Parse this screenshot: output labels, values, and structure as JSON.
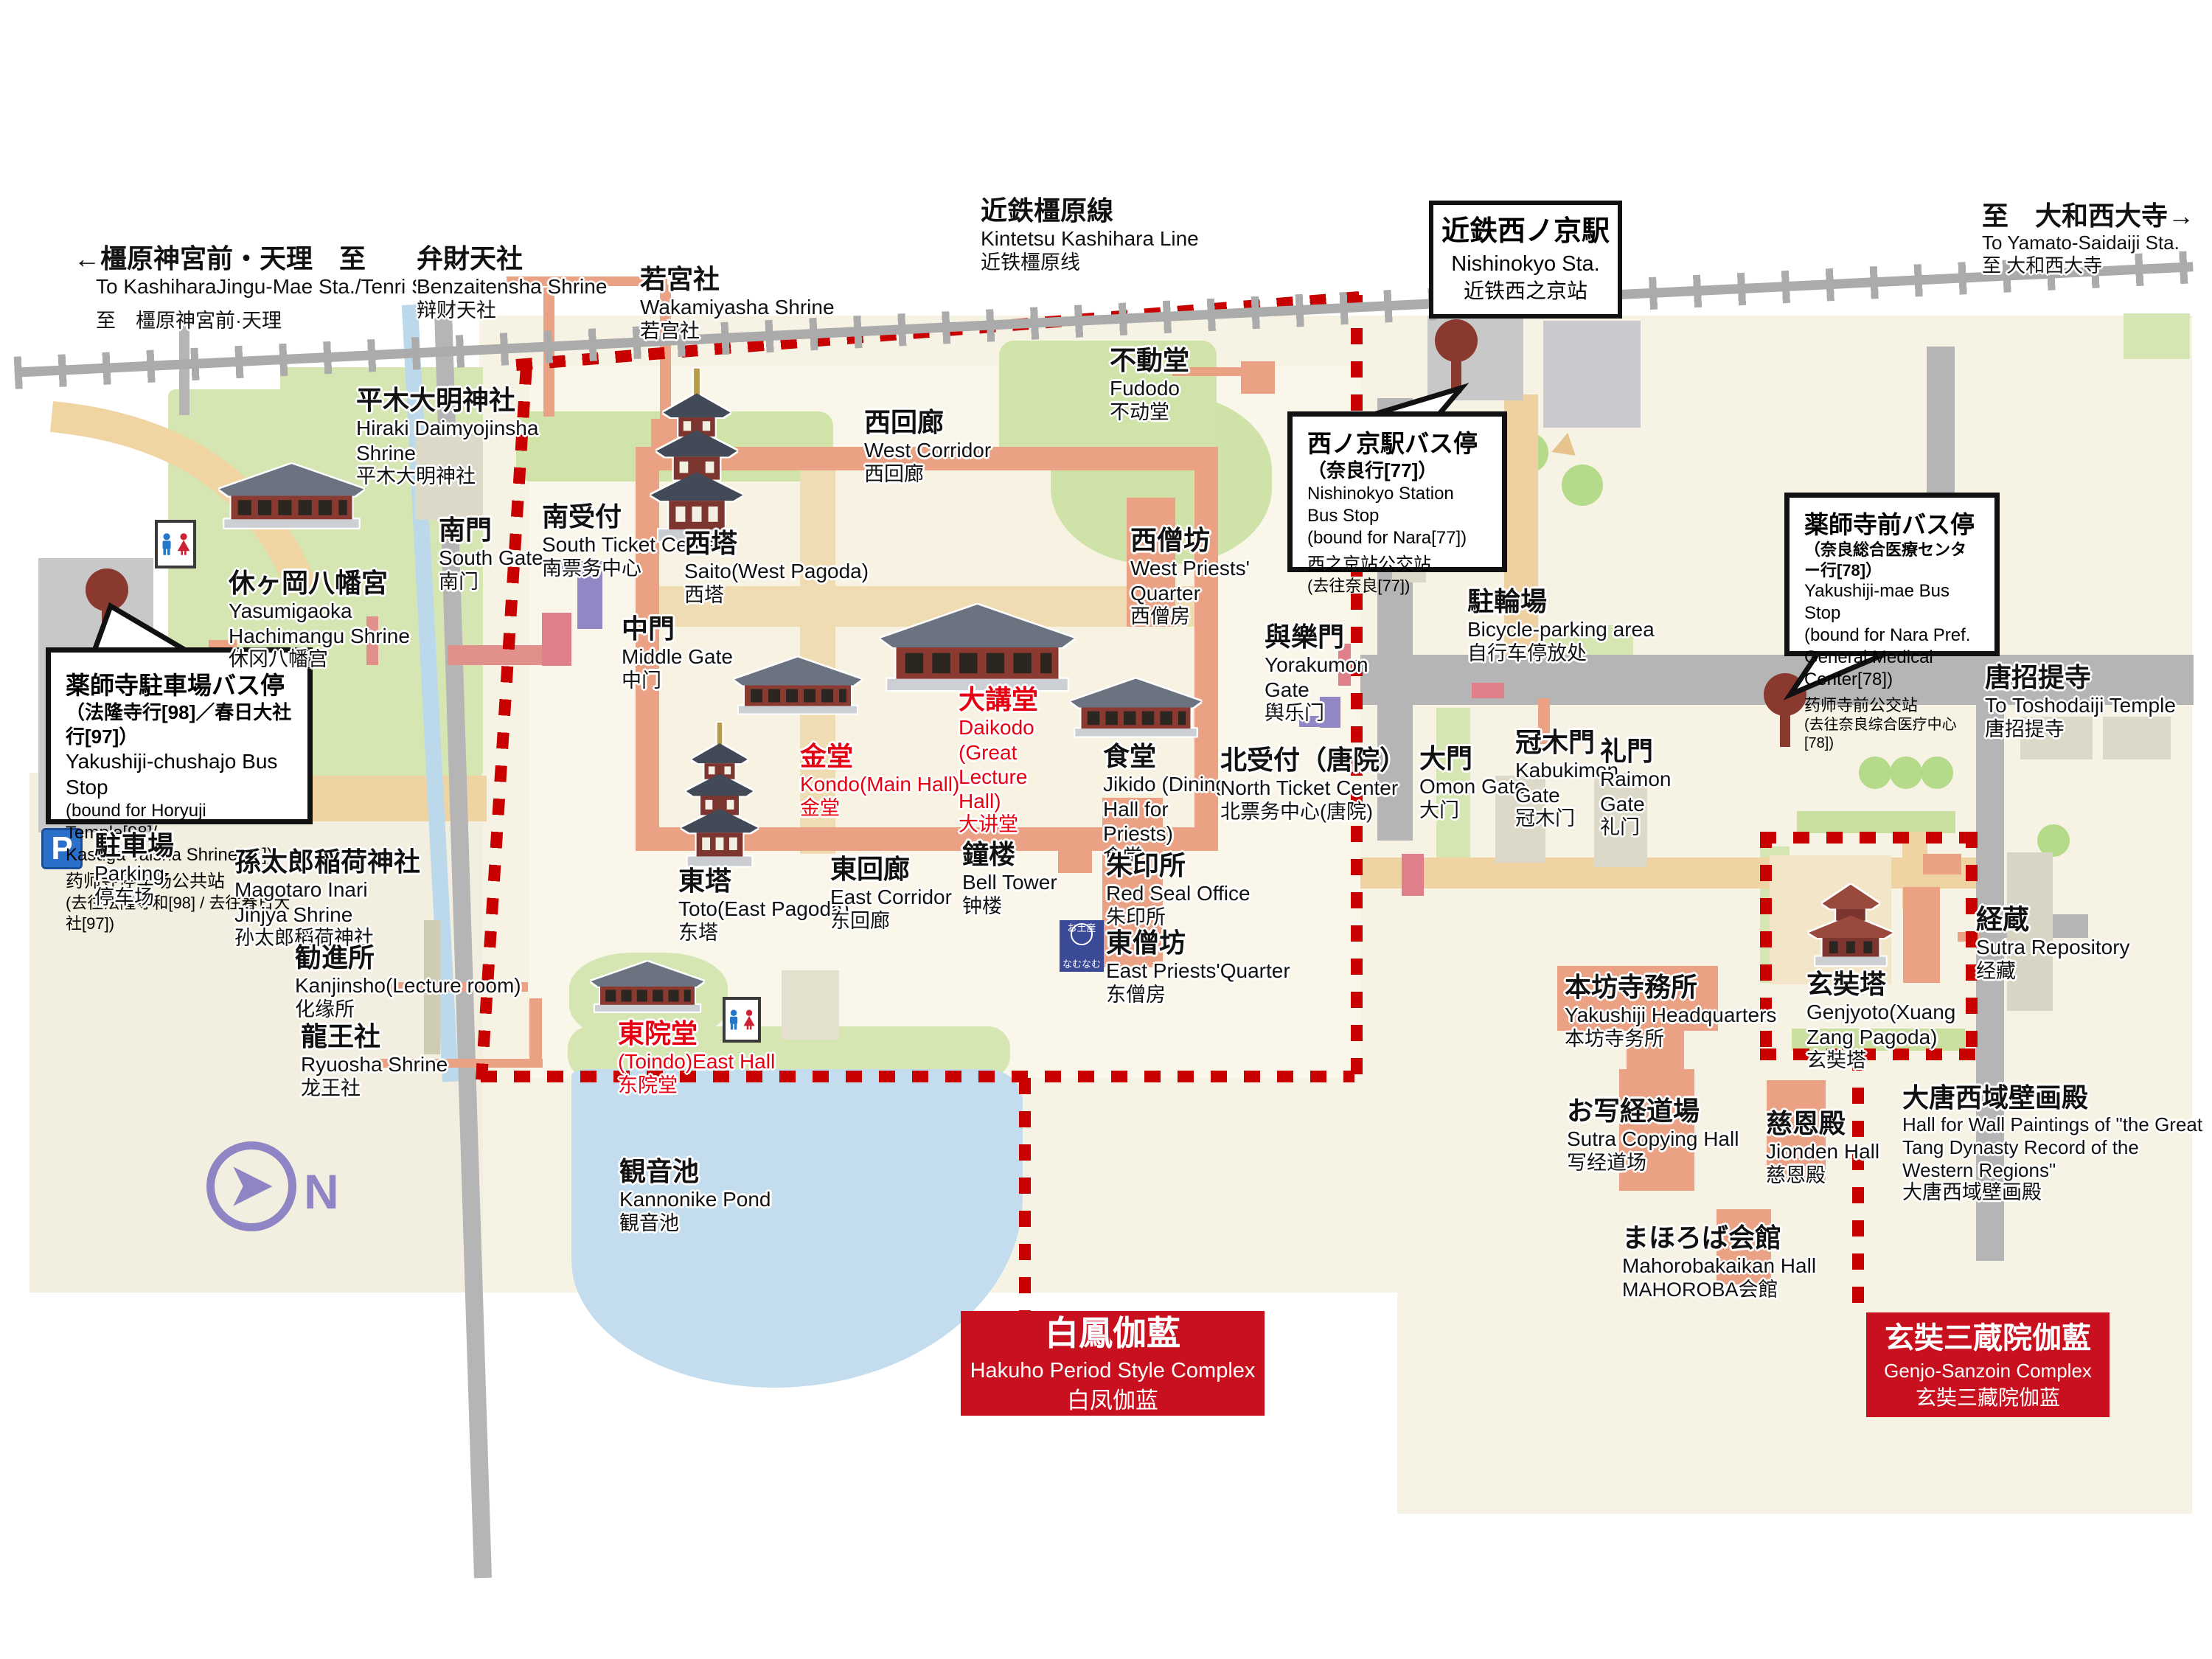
{
  "compass": {
    "label": "N"
  },
  "icons": {
    "parking_letter": "P",
    "shop_top": "お土産",
    "shop_bottom": "なむなむ"
  },
  "labels": [
    {
      "jp": "←橿原神宮前・天理　至",
      "en": "To KashiharaJingu-Mae Sta./Tenri Sta.",
      "cn": "至　橿原神宮前·天理"
    },
    {
      "jp": "弁財天社",
      "en": "Benzaitensha Shrine",
      "cn": "辩财天社"
    },
    {
      "jp": "若宮社",
      "en": "Wakamiyasha Shrine",
      "cn": "若宫社"
    },
    {
      "jp": "近鉄橿原線",
      "en": "Kintetsu Kashihara Line",
      "cn": "近铁橿原线"
    },
    {
      "jp": "至　大和西大寺→",
      "en": "To Yamato-Saidaiji Sta.",
      "cn": "至 大和西大寺"
    },
    {
      "jp": "平木大明神社",
      "en": "Hiraki Daimyojinsha Shrine",
      "cn": "平木大明神社"
    },
    {
      "jp": "南門",
      "en": "South Gate",
      "cn": "南门"
    },
    {
      "jp": "南受付",
      "en": "South Ticket Center",
      "cn": "南票务中心"
    },
    {
      "jp": "休ヶ岡八幡宮",
      "en": "Yasumigaoka Hachimangu Shrine",
      "cn": "休冈八幡宫"
    },
    {
      "jp": "駐車場",
      "en": "Parking",
      "cn": "停车场"
    },
    {
      "jp": "孫太郎稲荷神社",
      "en": "Magotaro Inari Jinjya Shrine",
      "cn": "孙太郎稻荷神社"
    },
    {
      "jp": "勧進所",
      "en": "Kanjinsho(Lecture room)",
      "cn": "化缘所"
    },
    {
      "jp": "龍王社",
      "en": "Ryuosha Shrine",
      "cn": "龙王社"
    },
    {
      "jp": "西塔",
      "en": "Saito(West Pagoda)",
      "cn": "西塔"
    },
    {
      "jp": "西回廊",
      "en": "West Corridor",
      "cn": "西回廊"
    },
    {
      "jp": "中門",
      "en": "Middle Gate",
      "cn": "中门"
    },
    {
      "jp": "金堂",
      "en": "Kondo(Main Hall)",
      "cn": "金堂"
    },
    {
      "jp": "大講堂",
      "en": "Daikodo (Great Lecture Hall)",
      "cn": "大讲堂"
    },
    {
      "jp": "西僧坊",
      "en": "West Priests' Quarter",
      "cn": "西僧房"
    },
    {
      "jp": "不動堂",
      "en": "Fudodo",
      "cn": "不动堂"
    },
    {
      "jp": "與樂門",
      "en": "Yorakumon Gate",
      "cn": "舆乐门"
    },
    {
      "jp": "食堂",
      "en": "Jikido (Dining Hall for Priests)",
      "cn": "食堂"
    },
    {
      "jp": "北受付（唐院）",
      "en": "North Ticket Center",
      "cn": "北票务中心(唐院)"
    },
    {
      "jp": "鐘楼",
      "en": "Bell Tower",
      "cn": "钟楼"
    },
    {
      "jp": "朱印所",
      "en": "Red Seal Office",
      "cn": "朱印所"
    },
    {
      "jp": "東僧坊",
      "en": "East Priests'Quarter",
      "cn": "东僧房"
    },
    {
      "jp": "東塔",
      "en": "Toto(East Pagoda)",
      "cn": "东塔"
    },
    {
      "jp": "東回廊",
      "en": "East Corridor",
      "cn": "东回廊"
    },
    {
      "jp": "東院堂",
      "en": "(Toindo)East Hall",
      "cn": "东院堂"
    },
    {
      "jp": "観音池",
      "en": "Kannonike Pond",
      "cn": "観音池"
    },
    {
      "jp": "駐輪場",
      "en": "Bicycle-parking area",
      "cn": "自行车停放处"
    },
    {
      "jp": "唐招提寺",
      "en": "To Toshodaiji Temple",
      "cn": "唐招提寺"
    },
    {
      "jp": "大門",
      "en": "Omon Gate",
      "cn": "大门"
    },
    {
      "jp": "冠木門",
      "en": "Kabukimon Gate",
      "cn": "冠木门"
    },
    {
      "jp": "礼門",
      "en": "Raimon Gate",
      "cn": "礼门"
    },
    {
      "jp": "経蔵",
      "en": "Sutra Repository",
      "cn": "经藏"
    },
    {
      "jp": "玄奘塔",
      "en": "Genjyoto(Xuang Zang Pagoda)",
      "cn": "玄奘塔"
    },
    {
      "jp": "本坊寺務所",
      "en": "Yakushiji Headquarters",
      "cn": "本坊寺务所"
    },
    {
      "jp": "大唐西域壁画殿",
      "en": "Hall for Wall Paintings of \"the Great Tang Dynasty Record of the Western Regions\"",
      "cn": "大唐西域壁画殿"
    },
    {
      "jp": "お写経道場",
      "en": "Sutra Copying Hall",
      "cn": "写经道场"
    },
    {
      "jp": "慈恩殿",
      "en": "Jionden Hall",
      "cn": "慈恩殿"
    },
    {
      "jp": "まほろば会館",
      "en": "Mahorobakaikan Hall",
      "cn": "MAHOROBA会館"
    }
  ],
  "callouts": {
    "station": {
      "jp": "近鉄西ノ京駅",
      "en": "Nishinokyo Sta.",
      "cn": "近铁西之京站"
    },
    "chushajo": {
      "jp": "薬師寺駐車場バス停",
      "jp2": "（法隆寺行[98]／春日大社行[97]）",
      "en": "Yakushiji-chushajo Bus Stop",
      "en2": "(bound for Horyuji Temple[98]/",
      "en3": "Kasuga Taisha Shrine[97])",
      "cn": "药师寺停车场公共站",
      "cn2": "(去往法隆寺和[98] / 去往春日大社[97])"
    },
    "nishinokyo_bus": {
      "jp": "西ノ京駅バス停",
      "jp2": "（奈良行[77]）",
      "en": "Nishinokyo Station Bus Stop",
      "en2": "(bound for Nara[77])",
      "cn": "西之京站公交站",
      "cn2": "(去往奈良[77])"
    },
    "yakushiji_mae": {
      "jp": "薬師寺前バス停",
      "jp2": "（奈良総合医療センター行[78]）",
      "en": "Yakushiji-mae Bus Stop",
      "en2": "(bound for Nara Pref.",
      "en3": "General Medical Center[78])",
      "cn": "药师寺前公交站",
      "cn2": "(去往奈良综合医疗中心[78])"
    }
  },
  "banners": {
    "hakuho": {
      "jp": "白鳳伽藍",
      "en": "Hakuho Period Style Complex",
      "cn": "白凤伽蓝"
    },
    "genjo": {
      "jp": "玄奘三蔵院伽藍",
      "en": "Genjo-Sanzoin Complex",
      "cn": "玄奘三藏院伽蓝"
    }
  },
  "colors": {
    "boundary_red": "#c80000",
    "banner_red": "#c8101e",
    "label_red": "#e60012",
    "road_gray": "#b5b5b5",
    "pond_blue": "#c3ddef",
    "green": "#d5e6b2",
    "corridor_salmon": "#eba184"
  }
}
